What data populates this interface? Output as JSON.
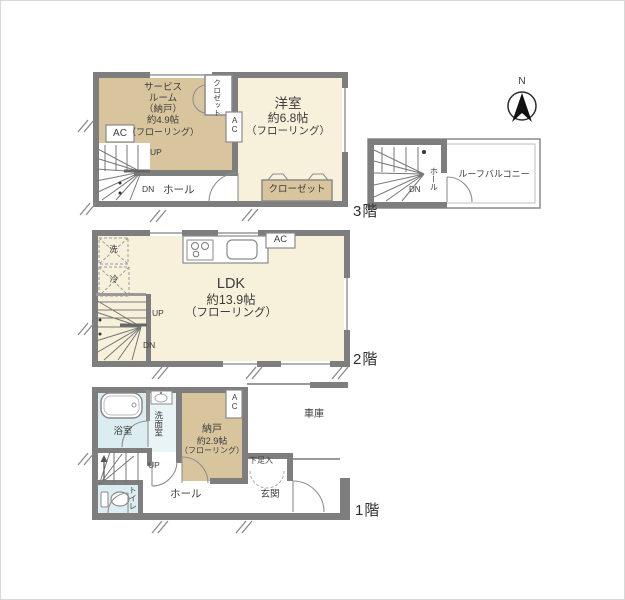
{
  "compass": {
    "north": "N"
  },
  "floor3": {
    "label": "3階",
    "service_room": [
      "サービス",
      "ルーム",
      "（納戸）",
      "約4.9帖",
      "（フローリング）"
    ],
    "western_room": [
      "洋室",
      "約6.8帖",
      "（フローリング）"
    ],
    "closet_small": "クロゼット",
    "closet": "クローゼット",
    "ac_left": "AC",
    "ac_mid": "AC",
    "up": "UP",
    "dn": "DN",
    "hall": "ホール"
  },
  "roof": {
    "balcony": "ルーフバルコニー",
    "hall": "ホール",
    "dn": "DN"
  },
  "floor2": {
    "label": "2階",
    "ldk": [
      "LDK",
      "約13.9帖",
      "（フローリング）"
    ],
    "ac": "AC",
    "washer": "洗",
    "fridge": "冷",
    "up": "UP",
    "dn": "DN"
  },
  "floor1": {
    "label": "1階",
    "bath": "浴室",
    "washroom": "洗面室",
    "toilet": "トイレ",
    "storage": [
      "納戸",
      "約2.9帖",
      "（フローリング）"
    ],
    "ac": "AC",
    "garage": "車庫",
    "shoe_box": "下足入",
    "entrance": "玄関",
    "hall": "ホール",
    "up": "UP"
  },
  "colors": {
    "wall": "#7E7E7E",
    "room_tan": "#D8C59D",
    "room_cream": "#F7F0DB",
    "room_blue": "#DCEDF1"
  }
}
